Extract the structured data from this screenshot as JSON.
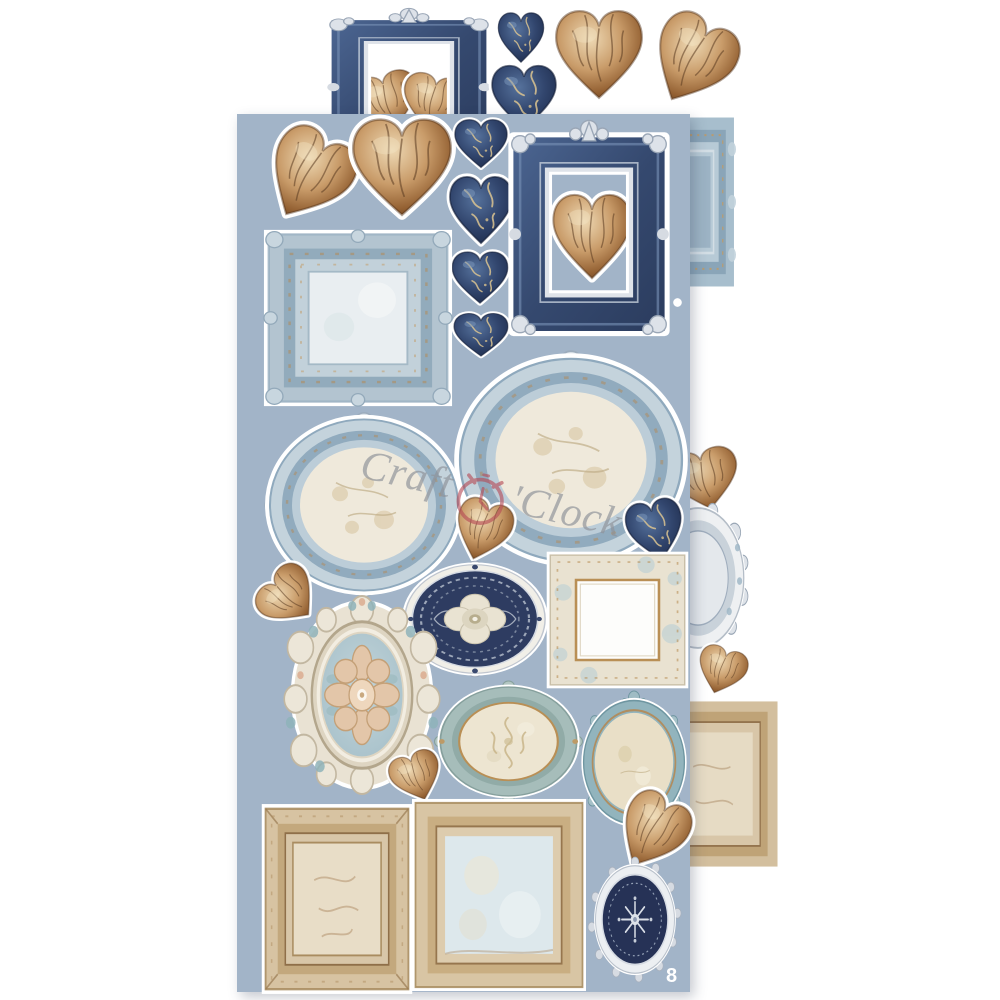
{
  "watermark": {
    "text_before": "Craft",
    "text_after": "'Clock",
    "text_color": "#8f939a",
    "clock_color": "#b54a55"
  },
  "page_number": "8",
  "palette": {
    "sheet_blue": "#a2b4c8",
    "sticker_white": "#ffffff",
    "navy": "#2e3c61",
    "denim_blue": "#35496f",
    "silver": "#d9dde4",
    "brown": "#936032",
    "brown_light": "#eed9b4",
    "gold": "#b98f55",
    "light_blue_frame": "#b3c4d0",
    "parchment": "#efe9db",
    "tan": "#d7c3a2",
    "cream": "#e9e2d1",
    "teal": "#92b4bd"
  },
  "front_sheet": {
    "x": 237,
    "y": 114,
    "w": 453,
    "h": 878
  },
  "elements": [
    {
      "name": "back-brown-heart-in-frame-left",
      "kind": "heartBrown",
      "layer": "back",
      "x": 350,
      "y": 70,
      "w": 76,
      "h": 66,
      "rot": -15
    },
    {
      "name": "back-brown-heart-in-frame-right",
      "kind": "heartBrown",
      "layer": "back",
      "x": 396,
      "y": 72,
      "w": 72,
      "h": 64,
      "rot": 12
    },
    {
      "name": "back-navy-rect-frame",
      "kind": "frameNavySilver",
      "layer": "back",
      "x": 323,
      "y": 6,
      "w": 172,
      "h": 160,
      "rot": 0
    },
    {
      "name": "back-navy-heart-small",
      "kind": "heartNavy",
      "layer": "back",
      "x": 494,
      "y": 10,
      "w": 54,
      "h": 58,
      "rot": 0
    },
    {
      "name": "back-navy-heart",
      "kind": "heartNavy",
      "layer": "back",
      "x": 486,
      "y": 62,
      "w": 76,
      "h": 74,
      "rot": 0
    },
    {
      "name": "back-brown-heart-large",
      "kind": "heartBrown",
      "layer": "back",
      "x": 548,
      "y": 6,
      "w": 102,
      "h": 102,
      "rot": 0
    },
    {
      "name": "back-brown-heart-tilted",
      "kind": "heartBrown",
      "layer": "back",
      "x": 643,
      "y": 12,
      "w": 96,
      "h": 102,
      "rot": 28
    },
    {
      "name": "back-blue-frame-partial",
      "kind": "frameBluePartial",
      "layer": "back",
      "x": 634,
      "y": 114,
      "w": 102,
      "h": 176,
      "rot": 0
    },
    {
      "name": "back-brown-heart-right",
      "kind": "heartBrown",
      "layer": "back",
      "x": 664,
      "y": 446,
      "w": 82,
      "h": 70,
      "rot": -12
    },
    {
      "name": "back-silver-oval-partial",
      "kind": "ovalSilverPartial",
      "layer": "back",
      "x": 646,
      "y": 502,
      "w": 104,
      "h": 152,
      "rot": 0
    },
    {
      "name": "back-brown-heart-small-right",
      "kind": "heartBrown",
      "layer": "back",
      "x": 692,
      "y": 645,
      "w": 58,
      "h": 54,
      "rot": 18
    },
    {
      "name": "back-tan-frame-partial",
      "kind": "frameTanPartial",
      "layer": "back",
      "x": 656,
      "y": 698,
      "w": 124,
      "h": 172,
      "rot": 0
    },
    {
      "name": "brown-heart-tilted-top-left",
      "kind": "heartBrown",
      "layer": "front",
      "x": 258,
      "y": 126,
      "w": 98,
      "h": 104,
      "rot": 30
    },
    {
      "name": "brown-heart-large-top",
      "kind": "heartBrown",
      "layer": "front",
      "x": 344,
      "y": 114,
      "w": 116,
      "h": 112,
      "rot": 0
    },
    {
      "name": "navy-heart-1",
      "kind": "heartNavy",
      "layer": "front",
      "x": 450,
      "y": 117,
      "w": 62,
      "h": 56,
      "rot": 0
    },
    {
      "name": "navy-heart-2",
      "kind": "heartNavy",
      "layer": "front",
      "x": 444,
      "y": 173,
      "w": 74,
      "h": 78,
      "rot": 0
    },
    {
      "name": "navy-heart-3",
      "kind": "heartNavy",
      "layer": "front",
      "x": 447,
      "y": 249,
      "w": 66,
      "h": 60,
      "rot": 0
    },
    {
      "name": "navy-heart-4",
      "kind": "heartNavy",
      "layer": "front",
      "x": 449,
      "y": 311,
      "w": 64,
      "h": 50,
      "rot": 0
    },
    {
      "name": "brown-heart-in-navy-frame",
      "kind": "heartBrown",
      "layer": "front",
      "x": 546,
      "y": 190,
      "w": 92,
      "h": 98,
      "rot": 0
    },
    {
      "name": "navy-rect-frame-with-heart",
      "kind": "frameNavySilver",
      "layer": "front",
      "x": 505,
      "y": 117,
      "w": 168,
      "h": 231,
      "rot": 0
    },
    {
      "name": "registration-dot",
      "kind": "dot",
      "layer": "front",
      "x": 673,
      "y": 298,
      "w": 9,
      "h": 9,
      "rot": 0
    },
    {
      "name": "blue-square-frame",
      "kind": "frameBlueSquare",
      "layer": "front",
      "x": 263,
      "y": 229,
      "w": 190,
      "h": 178,
      "rot": 0
    },
    {
      "name": "blue-oval-frame-large",
      "kind": "ovalBlueCream",
      "layer": "front",
      "x": 453,
      "y": 350,
      "w": 236,
      "h": 220,
      "rot": 0
    },
    {
      "name": "blue-oval-frame-left",
      "kind": "ovalBlueCream",
      "layer": "front",
      "x": 264,
      "y": 412,
      "w": 200,
      "h": 186,
      "rot": 0
    },
    {
      "name": "brown-heart-middle",
      "kind": "heartBrown",
      "layer": "front",
      "x": 449,
      "y": 497,
      "w": 66,
      "h": 70,
      "rot": 18
    },
    {
      "name": "navy-heart-middle-right",
      "kind": "heartNavy",
      "layer": "front",
      "x": 623,
      "y": 497,
      "w": 66,
      "h": 70,
      "rot": -12
    },
    {
      "name": "brown-heart-left",
      "kind": "heartBrown",
      "layer": "front",
      "x": 254,
      "y": 567,
      "w": 72,
      "h": 62,
      "rot": -48
    },
    {
      "name": "navy-damask-oval",
      "kind": "ovalNavyDamask",
      "layer": "front",
      "x": 402,
      "y": 560,
      "w": 146,
      "h": 118,
      "rot": 0
    },
    {
      "name": "cream-square-frame",
      "kind": "frameCreamSquare",
      "layer": "front",
      "x": 546,
      "y": 551,
      "w": 143,
      "h": 138,
      "rot": 0
    },
    {
      "name": "baroque-oval-frame",
      "kind": "ovalBaroque",
      "layer": "front",
      "x": 281,
      "y": 596,
      "w": 162,
      "h": 198,
      "rot": 0
    },
    {
      "name": "bluegreen-oval-frame",
      "kind": "ovalBlueGreen",
      "layer": "front",
      "x": 436,
      "y": 681,
      "w": 145,
      "h": 121,
      "rot": 0
    },
    {
      "name": "teal-oval-frame",
      "kind": "ovalTeal",
      "layer": "front",
      "x": 578,
      "y": 691,
      "w": 112,
      "h": 137,
      "rot": 0
    },
    {
      "name": "brown-heart-small-middle",
      "kind": "heartBrown",
      "layer": "front",
      "x": 387,
      "y": 750,
      "w": 60,
      "h": 56,
      "rot": -20
    },
    {
      "name": "tan-frame-portrait",
      "kind": "frameTanPortrait",
      "layer": "front",
      "x": 261,
      "y": 805,
      "w": 152,
      "h": 188,
      "rot": 0
    },
    {
      "name": "tan-frame-square",
      "kind": "frameTanSquare",
      "layer": "front",
      "x": 412,
      "y": 797,
      "w": 174,
      "h": 196,
      "rot": 0
    },
    {
      "name": "brown-heart-bottom-right",
      "kind": "heartBrown",
      "layer": "front",
      "x": 612,
      "y": 790,
      "w": 78,
      "h": 88,
      "rot": 30
    },
    {
      "name": "navy-lace-oval",
      "kind": "ovalNavyLace",
      "layer": "front",
      "x": 588,
      "y": 857,
      "w": 94,
      "h": 125,
      "rot": 0
    }
  ]
}
